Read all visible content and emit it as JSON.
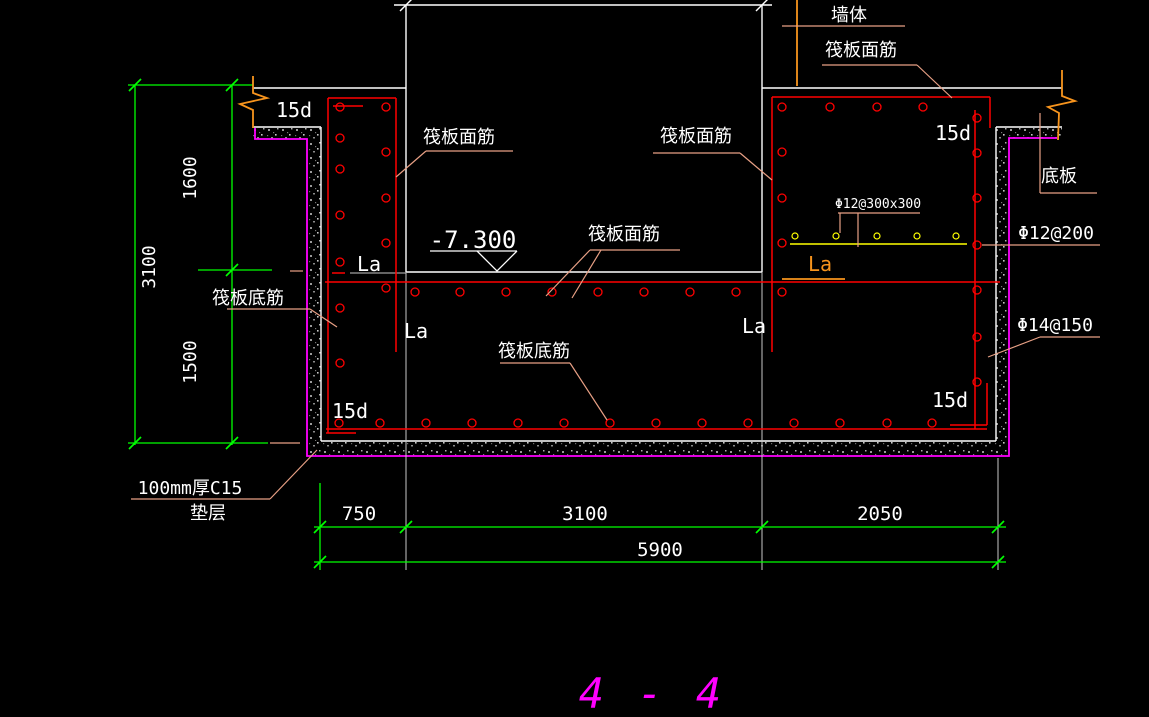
{
  "drawing": {
    "section_title": "4 - 4",
    "labels": {
      "wall": "墙体",
      "raft_top_rebar": "筏板面筋",
      "raft_bottom_rebar": "筏板底筋",
      "anchorage": "15d",
      "lap_length": "La",
      "elevation": "-7.300",
      "pit_mesh": "Φ12@300x300",
      "right_wall_bar_upper": "Φ12@200",
      "right_wall_bar_lower": "Φ14@150",
      "bottom_slab": "底板",
      "cushion_line1": "100mm厚C15",
      "cushion_line2": "垫层"
    },
    "dimensions": {
      "left_total": "3100",
      "left_upper": "1600",
      "left_lower": "1500",
      "bottom_seg1": "750",
      "bottom_seg2": "3100",
      "bottom_seg3": "2050",
      "bottom_total": "5900"
    },
    "colors": {
      "outline": "#ffffff",
      "dimension": "#00ff00",
      "rebar": "#ff0000",
      "cushion": "#ff00ff",
      "leader": "#e8a085",
      "break_line": "#f7941d",
      "mesh": "#ffff00",
      "extension": "#c8c8c8"
    }
  }
}
